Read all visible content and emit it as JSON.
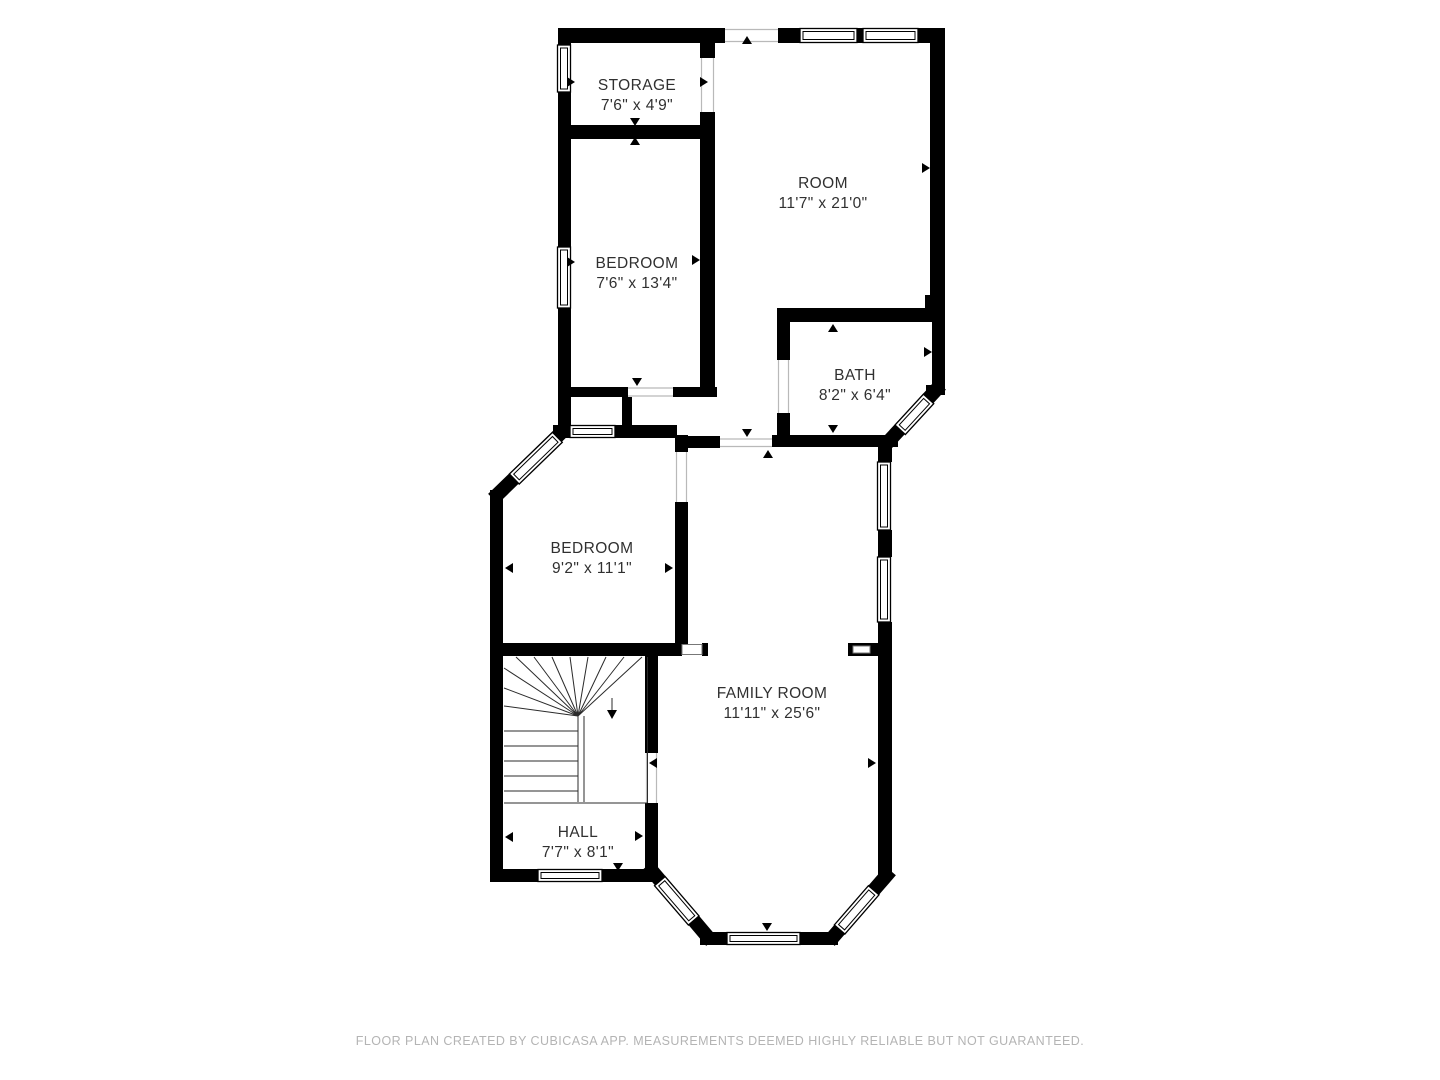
{
  "rooms": [
    {
      "name": "STORAGE",
      "dims": "7'6\" x 4'9\""
    },
    {
      "name": "ROOM",
      "dims": "11'7\" x 21'0\""
    },
    {
      "name": "BEDROOM",
      "dims": "7'6\" x 13'4\""
    },
    {
      "name": "BATH",
      "dims": "8'2\" x 6'4\""
    },
    {
      "name": "BEDROOM",
      "dims": "9'2\" x 11'1\""
    },
    {
      "name": "FAMILY ROOM",
      "dims": "11'11\" x 25'6\""
    },
    {
      "name": "HALL",
      "dims": "7'7\" x 8'1\""
    }
  ],
  "footer": {
    "text": "FLOOR PLAN CREATED BY CUBICASA APP. MEASUREMENTS DEEMED HIGHLY RELIABLE BUT NOT GUARANTEED."
  },
  "colors": {
    "wall": "#000000",
    "background": "#ffffff",
    "label": "#303030",
    "footer": "#b4b4b4"
  }
}
